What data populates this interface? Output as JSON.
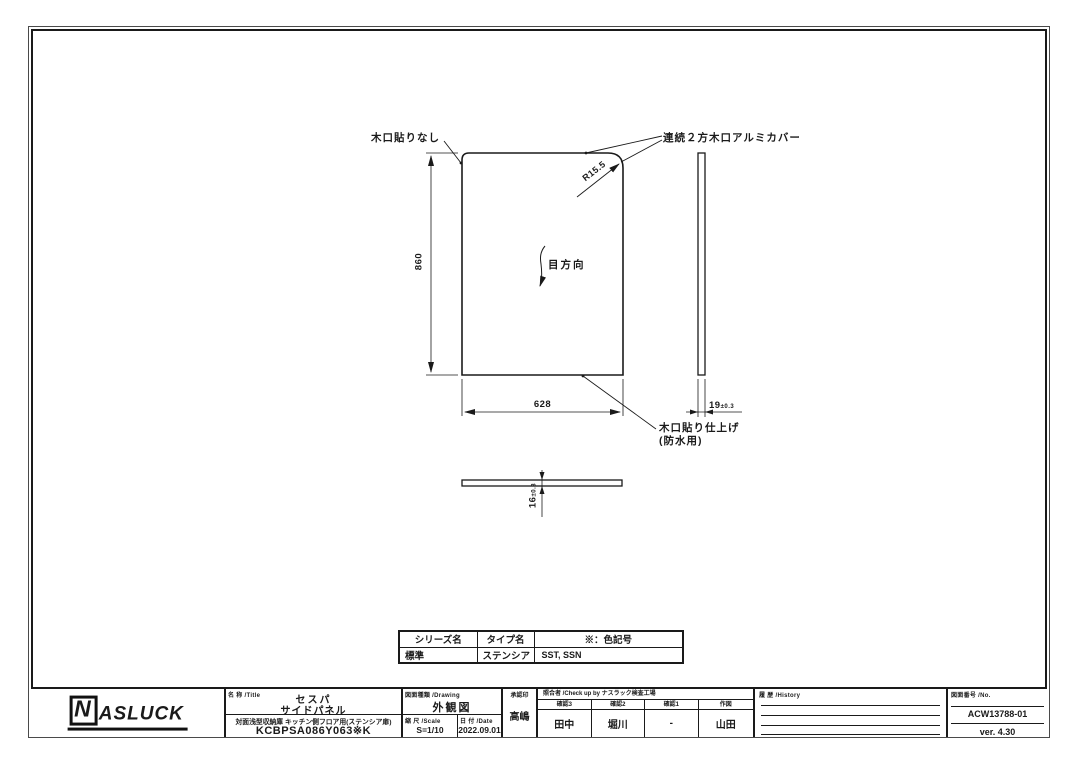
{
  "colors": {
    "ink": "#1a1a1a",
    "background": "#ffffff"
  },
  "drawing": {
    "label_no_edge_band": "木口貼りなし",
    "label_alumi_cover": "連続２方木口アルミカバー",
    "corner_radius": "R15.5",
    "dim_height": "860",
    "grain_direction": "目方向",
    "dim_width": "628",
    "dim_thickness": "19",
    "dim_thickness_tol": "±0.3",
    "label_edge_finish_1": "木口貼り仕上げ",
    "label_edge_finish_2": "(防水用)",
    "dim_bottom_thickness": "16",
    "dim_bottom_thickness_tol": "±0.3"
  },
  "spec_table": {
    "headers": [
      "シリーズ名",
      "タイプ名",
      "※：色記号"
    ],
    "rows": [
      [
        "標準",
        "ステンシア",
        "SST, SSN"
      ]
    ]
  },
  "title_block": {
    "logo_n": "N",
    "logo_rest": "ASLUCK",
    "title_label": "名 称 /Title",
    "title_line1": "セスパ",
    "title_line2": "サイドパネル",
    "subtitle": "対面浅型収納庫 キッチン側フロア用(ステンシア扉)",
    "model_code": "KCBPSA086Y063※K",
    "drawing_label": "図面種類 /Drawing",
    "drawing_type": "外観図",
    "scale_label": "縮 尺 /Scale",
    "scale_value": "S=1/10",
    "date_label": "日 付 /Date",
    "date_value": "2022.09.01",
    "approval_label": "承認印",
    "approval_value": "高嶋",
    "check_label": "照合者 /Check up by ナスラック検査工場",
    "checks": [
      {
        "label": "確認3",
        "value": "田中"
      },
      {
        "label": "確認2",
        "value": "堀川"
      },
      {
        "label": "確認1",
        "value": "-"
      },
      {
        "label": "作図",
        "value": "山田"
      }
    ],
    "history_label": "履 歴 /History",
    "no_label": "図面番号 /No.",
    "drawing_no": "ACW13788-01",
    "version": "ver. 4.30"
  }
}
